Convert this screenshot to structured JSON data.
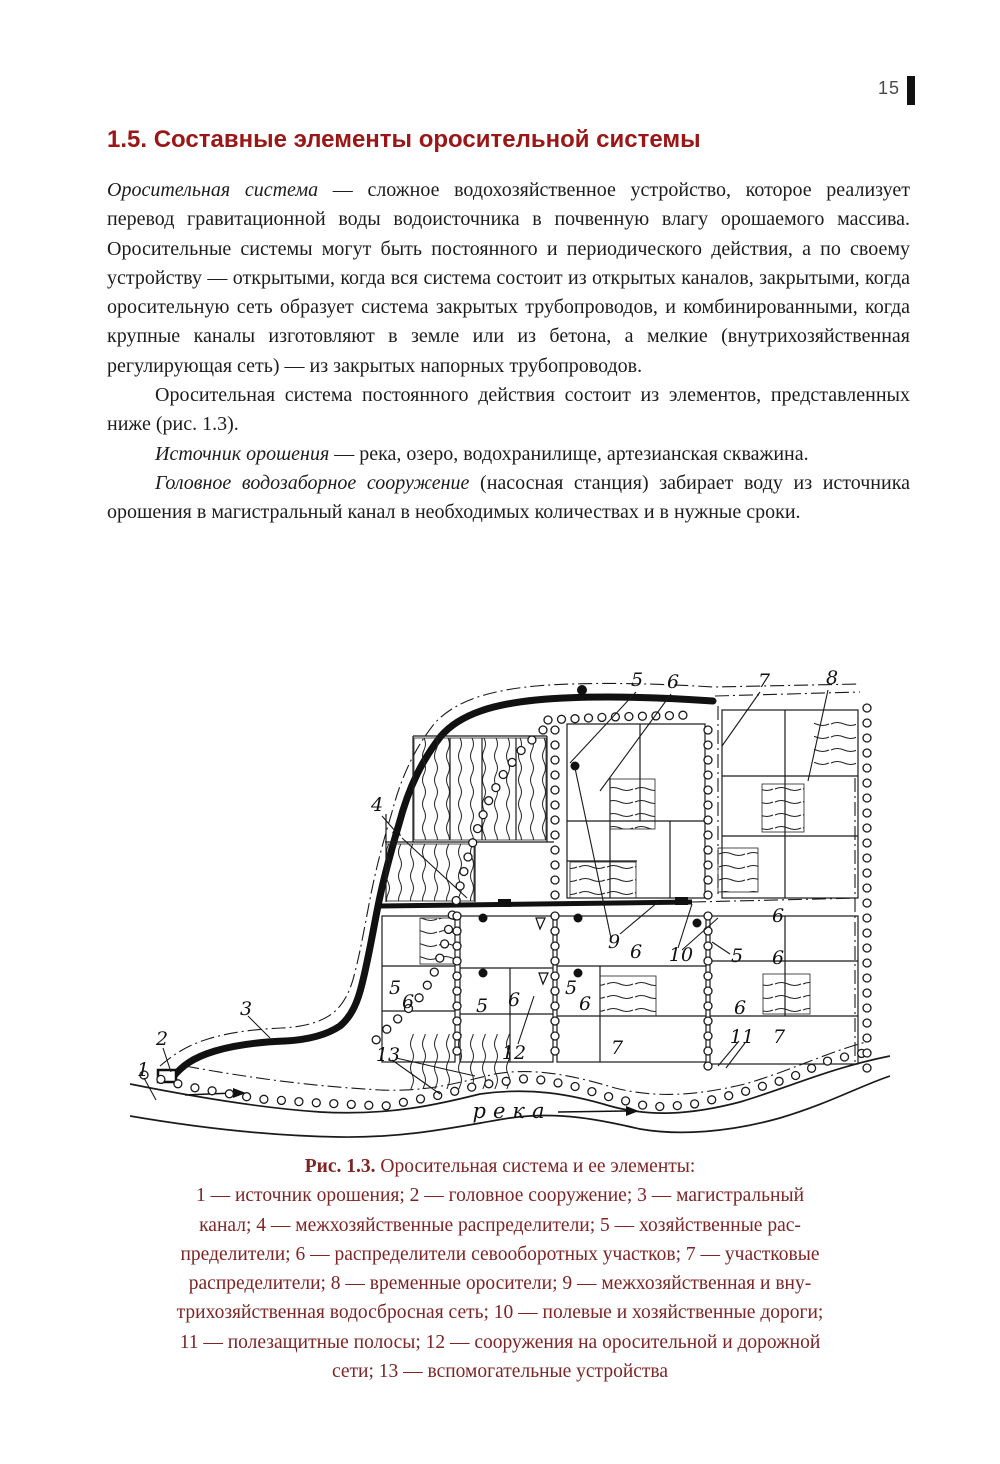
{
  "page_number": "15",
  "heading": "1.5. Составные элементы оросительной системы",
  "paragraphs": [
    {
      "lead": "Оросительная система",
      "text": " — сложное водохозяйственное устройство, которое реализует перевод гравитационной воды водоисточника в почвенную влагу орошаемого массива. Оросительные системы могут быть постоянного и периодического действия, а по своему устройству — открытыми, когда вся система состоит из открытых каналов, закрытыми, когда оросительную сеть образует система закрытых трубопроводов, и комбинированными, когда крупные каналы изготовляют в земле или из бетона, а мелкие (внутрихозяйственная регулирующая сеть) — из закрытых напорных трубопроводов."
    },
    {
      "lead": "",
      "text": "Оросительная система постоянного действия состоит из элементов, представленных ниже (рис. 1.3)."
    },
    {
      "lead": "Источник орошения",
      "text": " — река, озеро, водохранилище, артезианская скважина."
    },
    {
      "lead": "Головное водозаборное сооружение",
      "text": " (насосная станция) забирает воду из источника орошения в магистральный канал в необходимых количествах и в нужные сроки."
    }
  ],
  "figure": {
    "river_label": "река",
    "labels": [
      {
        "t": "5",
        "x": 507,
        "y": 20
      },
      {
        "t": "6",
        "x": 543,
        "y": 22
      },
      {
        "t": "7",
        "x": 634,
        "y": 21
      },
      {
        "t": "8",
        "x": 702,
        "y": 18
      },
      {
        "t": "4",
        "x": 247,
        "y": 145
      },
      {
        "t": "9",
        "x": 484,
        "y": 282
      },
      {
        "t": "6",
        "x": 506,
        "y": 292
      },
      {
        "t": "10",
        "x": 551,
        "y": 295
      },
      {
        "t": "6",
        "x": 648,
        "y": 256
      },
      {
        "t": "5",
        "x": 607,
        "y": 296
      },
      {
        "t": "6",
        "x": 648,
        "y": 298
      },
      {
        "t": "5",
        "x": 265,
        "y": 328
      },
      {
        "t": "6",
        "x": 278,
        "y": 342
      },
      {
        "t": "5",
        "x": 352,
        "y": 346
      },
      {
        "t": "6",
        "x": 384,
        "y": 340
      },
      {
        "t": "5",
        "x": 441,
        "y": 328
      },
      {
        "t": "6",
        "x": 455,
        "y": 344
      },
      {
        "t": "6",
        "x": 610,
        "y": 348
      },
      {
        "t": "12",
        "x": 384,
        "y": 393
      },
      {
        "t": "7",
        "x": 487,
        "y": 388
      },
      {
        "t": "11",
        "x": 612,
        "y": 377
      },
      {
        "t": "7",
        "x": 649,
        "y": 377
      },
      {
        "t": "13",
        "x": 258,
        "y": 395
      },
      {
        "t": "3",
        "x": 116,
        "y": 349
      },
      {
        "t": "2",
        "x": 32,
        "y": 379
      },
      {
        "t": "1",
        "x": 13,
        "y": 410
      }
    ]
  },
  "caption": {
    "figure_ref": "Рис. 1.3.",
    "title": " Оросительная система и ее элементы:",
    "legend_lines": [
      "1 — источник орошения; 2 — головное сооружение; 3 — магистральный",
      "канал; 4 — межхозяйственные распределители; 5 — хозяйственные рас-",
      "пределители; 6 — распределители севооборотных участков; 7 — участковые",
      "распределители; 8 — временные оросители; 9 — межхозяйственная и вну-",
      "трихозяйственная водосбросная сеть; 10 — полевые и хозяйственные дороги;",
      "11 — полезащитные полосы; 12 — сооружения на оросительной и дорожной",
      "сети; 13 — вспомогательные устройства"
    ]
  },
  "colors": {
    "heading": "#9b1616",
    "caption": "#7e2424",
    "ink": "#1a1a1a"
  }
}
